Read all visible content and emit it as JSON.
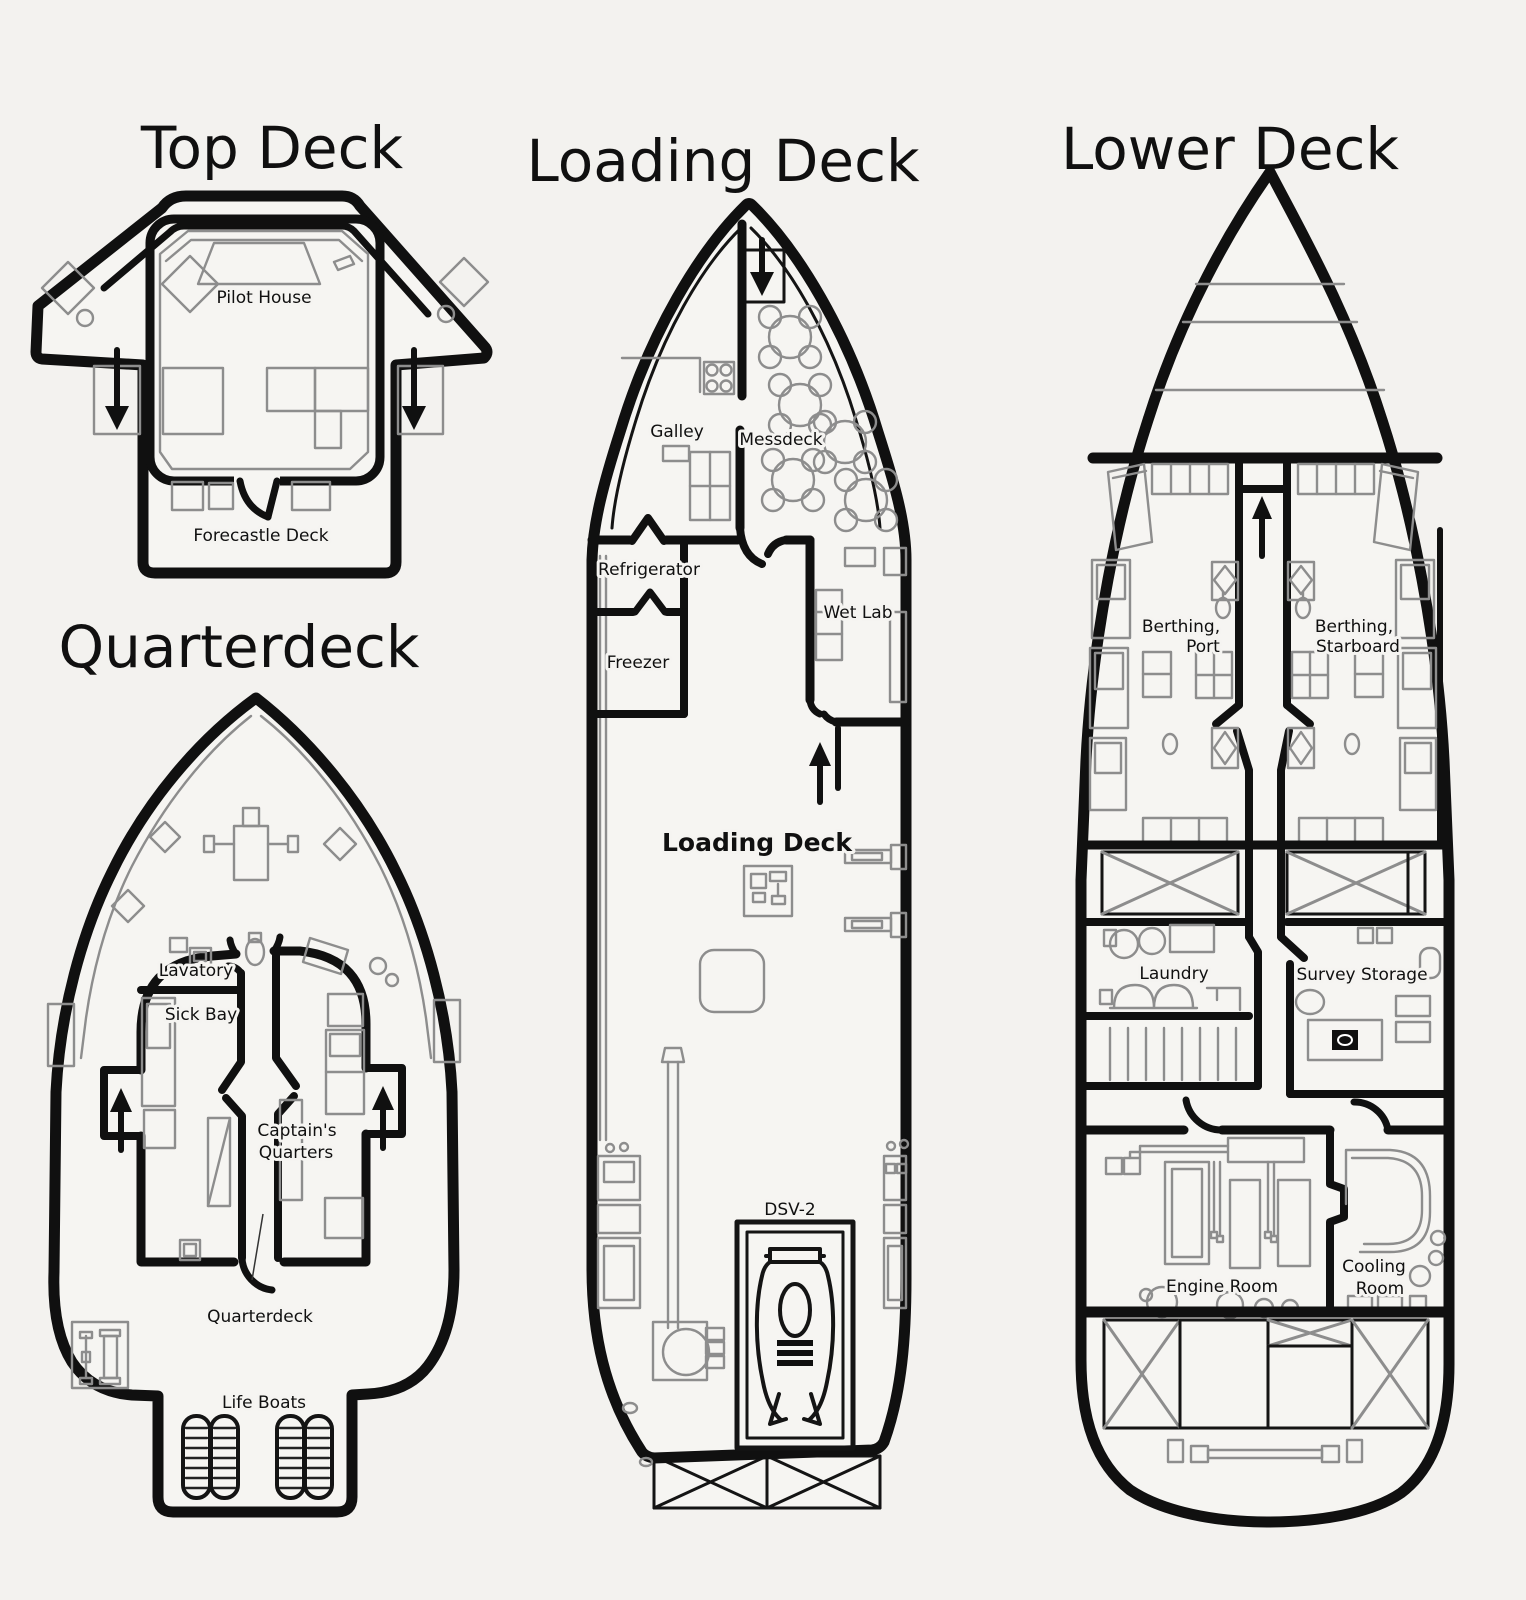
{
  "page": {
    "background": "#f3f2ef",
    "plan_fill": "#f6f5f2",
    "ink": "#101010",
    "detail_gray": "#8d8d8d"
  },
  "decks": {
    "top_deck": {
      "title": "Top Deck",
      "labels": {
        "pilot_house": "Pilot House",
        "forecastle_deck": "Forecastle Deck"
      }
    },
    "quarterdeck": {
      "title": "Quarterdeck",
      "labels": {
        "lavatory": "Lavatory",
        "sick_bay": "Sick Bay",
        "captains_quarters_line1": "Captain's",
        "captains_quarters_line2": "Quarters",
        "quarterdeck": "Quarterdeck",
        "life_boats": "Life Boats"
      }
    },
    "loading_deck": {
      "title": "Loading Deck",
      "labels": {
        "galley": "Galley",
        "messdeck": "Messdeck",
        "refrigerator": "Refrigerator",
        "freezer": "Freezer",
        "wet_lab": "Wet Lab",
        "loading_deck": "Loading Deck",
        "dsv_2": "DSV-2"
      }
    },
    "lower_deck": {
      "title": "Lower Deck",
      "labels": {
        "berthing_port_line1": "Berthing,",
        "berthing_port_line2": "Port",
        "berthing_starboard_line1": "Berthing,",
        "berthing_starboard_line2": "Starboard",
        "laundry": "Laundry",
        "survey_storage": "Survey Storage",
        "engine_room": "Engine Room",
        "cooling_room_line1": "Cooling",
        "cooling_room_line2": "Room"
      }
    }
  }
}
